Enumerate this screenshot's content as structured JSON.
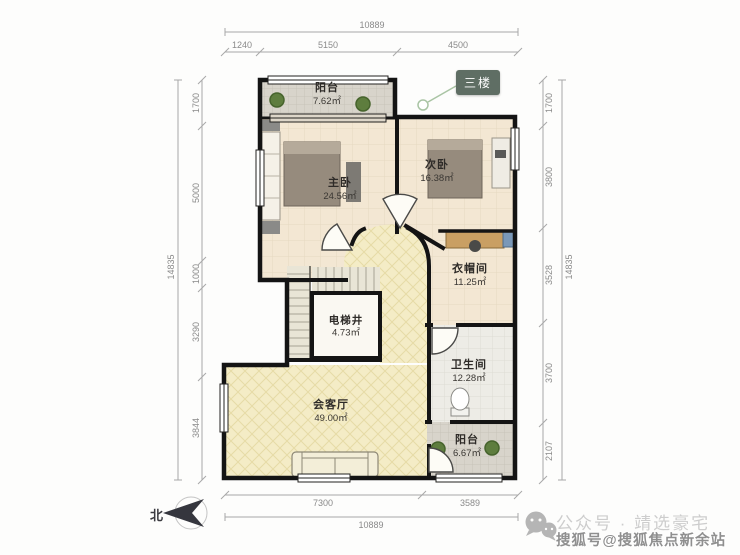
{
  "plan": {
    "floor_badge": "三楼",
    "compass_label": "北",
    "rooms": [
      {
        "id": "balcony-top",
        "name": "阳台",
        "area": "7.62㎡"
      },
      {
        "id": "master-bedroom",
        "name": "主卧",
        "area": "24.56㎡"
      },
      {
        "id": "second-bedroom",
        "name": "次卧",
        "area": "16.38㎡"
      },
      {
        "id": "cloakroom",
        "name": "衣帽间",
        "area": "11.25㎡"
      },
      {
        "id": "elevator-shaft",
        "name": "电梯井",
        "area": "4.73㎡"
      },
      {
        "id": "bathroom",
        "name": "卫生间",
        "area": "12.28㎡"
      },
      {
        "id": "living-room",
        "name": "会客厅",
        "area": "49.00㎡"
      },
      {
        "id": "balcony-bottom",
        "name": "阳台",
        "area": "6.67㎡"
      }
    ]
  },
  "dimensions": {
    "top": {
      "overall": "10889",
      "segments": [
        "1240",
        "5150",
        "4500"
      ]
    },
    "bottom": {
      "overall": "10889",
      "segments": [
        "7300",
        "3589"
      ]
    },
    "left": {
      "overall": "14835",
      "segments": [
        "1700",
        "5000",
        "1000",
        "3290",
        "3844"
      ]
    },
    "right": {
      "overall": "14835",
      "segments": [
        "1700",
        "3800",
        "3528",
        "3700",
        "2107"
      ]
    }
  },
  "watermarks": {
    "wechat_account": "公众号 · 靖选豪宅",
    "sohu_account": "搜狐号@搜狐焦点新余站"
  },
  "colors": {
    "wall": "#141414",
    "bedroom_floor": "#f3e7d3",
    "living_floor": "#f4ecc6",
    "balcony_floor": "#d8d4cb",
    "bathroom_floor": "#edece6",
    "badge_bg": "#5f6e64",
    "plant_green": "#5e7d3e"
  }
}
